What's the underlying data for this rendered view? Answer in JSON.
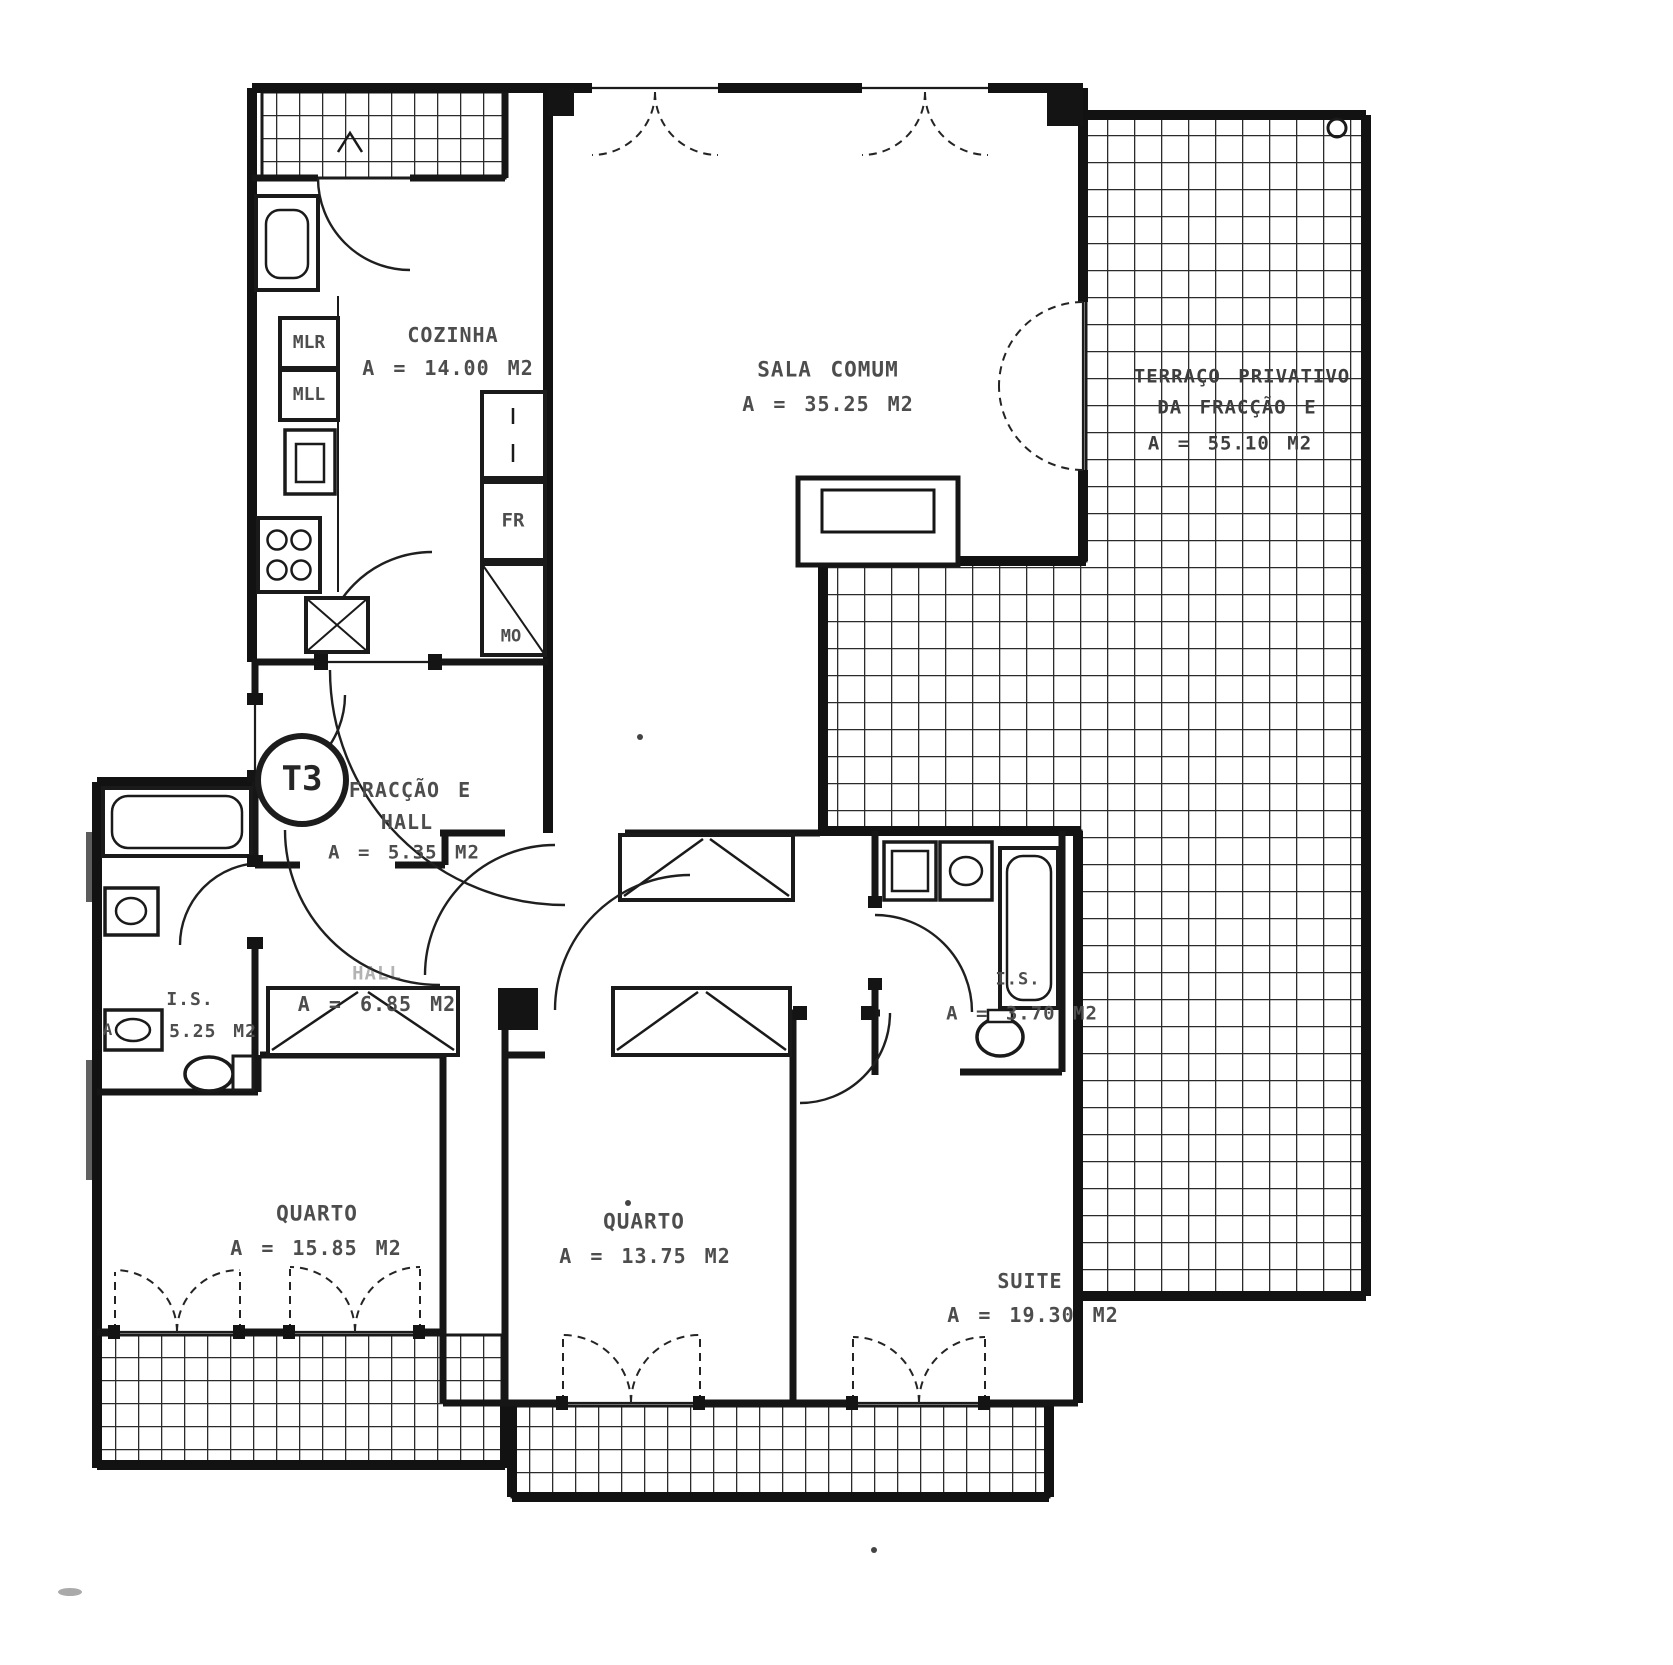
{
  "badge": {
    "label": "T3"
  },
  "rooms": {
    "cozinha": {
      "label": "COZINHA",
      "area": "A = 14.00 M2"
    },
    "sala": {
      "label": "SALA COMUM",
      "area": "A = 35.25 M2"
    },
    "terraco": {
      "line1": "TERRAÇO PRIVATIVO",
      "line2": "DA FRACÇÃO E",
      "area": "A = 55.10 M2"
    },
    "fraccao_hall": {
      "line1": "FRACÇÃO E",
      "line2": "HALL",
      "area": "A = 5.35 M2"
    },
    "hall": {
      "label": "HALL",
      "area": "A = 6.85 M2"
    },
    "is_left": {
      "label": "I.S.",
      "area_prefix": "A",
      "area": "5.25 M2"
    },
    "is_right": {
      "label": "I.S.",
      "area": "A = 3.70 M2"
    },
    "quarto1": {
      "label": "QUARTO",
      "area": "A = 15.85 M2"
    },
    "quarto2": {
      "label": "QUARTO",
      "area": "A = 13.75 M2"
    },
    "suite": {
      "label": "SUITE",
      "area": "A = 19.30 M2"
    }
  },
  "appliances": {
    "mlr": "MLR",
    "mll": "MLL",
    "fr": "FR",
    "mo": "MO"
  },
  "colors": {
    "ink": "#141414",
    "label_gray": "#4d4d4d",
    "paper": "#ffffff"
  }
}
